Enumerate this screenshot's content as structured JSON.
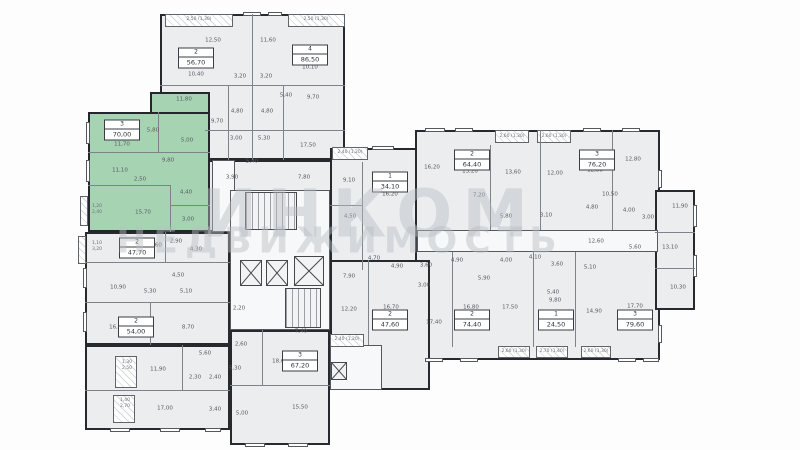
{
  "watermark": {
    "line1": "ИНКОМ",
    "line2": "НЕДВИЖИМОСТЬ"
  },
  "selected_apartment": {
    "number": "3",
    "area": "70,00",
    "highlight_color": "#a6d4b2"
  },
  "palette": {
    "wall": "#26292d",
    "room_fill": "#ebedef",
    "hall_fill": "#f7f8f9",
    "selected_fill": "#a6d4b2",
    "label_color": "#555a60",
    "watermark_color": "#b9bec3"
  },
  "blocks": [
    {
      "name": "block-top-left",
      "x": 160,
      "y": 14,
      "w": 185,
      "h": 146,
      "fill": "room"
    },
    {
      "name": "block-top-mid",
      "x": 205,
      "y": 160,
      "w": 140,
      "h": 72,
      "fill": "room"
    },
    {
      "name": "corridor-strip-left",
      "x": 212,
      "y": 160,
      "w": 23,
      "h": 72,
      "fill": "hall"
    },
    {
      "name": "block-left-column",
      "x": 85,
      "y": 232,
      "w": 145,
      "h": 113,
      "fill": "room"
    },
    {
      "name": "block-bottom-left",
      "x": 85,
      "y": 345,
      "w": 145,
      "h": 85,
      "fill": "room"
    },
    {
      "name": "block-core",
      "x": 230,
      "y": 190,
      "w": 100,
      "h": 140,
      "fill": "hall"
    },
    {
      "name": "block-apartment-1-34",
      "x": 330,
      "y": 148,
      "w": 88,
      "h": 122,
      "fill": "room"
    },
    {
      "name": "block-right-wing",
      "x": 415,
      "y": 130,
      "w": 245,
      "h": 230,
      "fill": "room"
    },
    {
      "name": "block-far-right",
      "x": 655,
      "y": 190,
      "w": 40,
      "h": 120,
      "fill": "room"
    },
    {
      "name": "block-bottom-center",
      "x": 230,
      "y": 330,
      "w": 100,
      "h": 115,
      "fill": "room"
    },
    {
      "name": "block-connector",
      "x": 330,
      "y": 260,
      "w": 100,
      "h": 130,
      "fill": "room"
    },
    {
      "name": "corridor-right-wing",
      "x": 417,
      "y": 230,
      "w": 241,
      "h": 22,
      "fill": "hall"
    },
    {
      "name": "corridor-connector-lobby",
      "x": 330,
      "y": 345,
      "w": 52,
      "h": 45,
      "fill": "hall"
    },
    {
      "name": "apartment-3-selected",
      "x": 88,
      "y": 112,
      "w": 122,
      "h": 120,
      "fill": "green"
    },
    {
      "name": "apartment-3-selected-upper",
      "x": 150,
      "y": 92,
      "w": 60,
      "h": 22,
      "fill": "green"
    }
  ],
  "partitions": [
    {
      "x": 252,
      "y": 14,
      "w": 1,
      "h": 146
    },
    {
      "x": 160,
      "y": 85,
      "w": 92,
      "h": 1
    },
    {
      "x": 252,
      "y": 85,
      "w": 93,
      "h": 1
    },
    {
      "x": 228,
      "y": 85,
      "w": 1,
      "h": 75
    },
    {
      "x": 283,
      "y": 85,
      "w": 1,
      "h": 75
    },
    {
      "x": 205,
      "y": 130,
      "w": 140,
      "h": 1
    },
    {
      "x": 88,
      "y": 152,
      "w": 122,
      "h": 1
    },
    {
      "x": 158,
      "y": 112,
      "w": 1,
      "h": 40
    },
    {
      "x": 88,
      "y": 185,
      "w": 82,
      "h": 1
    },
    {
      "x": 170,
      "y": 185,
      "w": 1,
      "h": 47
    },
    {
      "x": 170,
      "y": 205,
      "w": 40,
      "h": 1
    },
    {
      "x": 85,
      "y": 262,
      "w": 145,
      "h": 1
    },
    {
      "x": 85,
      "y": 302,
      "w": 145,
      "h": 1
    },
    {
      "x": 150,
      "y": 302,
      "w": 1,
      "h": 43
    },
    {
      "x": 165,
      "y": 232,
      "w": 1,
      "h": 30
    },
    {
      "x": 85,
      "y": 390,
      "w": 145,
      "h": 1
    },
    {
      "x": 182,
      "y": 345,
      "w": 1,
      "h": 45
    },
    {
      "x": 230,
      "y": 385,
      "w": 100,
      "h": 1
    },
    {
      "x": 262,
      "y": 330,
      "w": 1,
      "h": 55
    },
    {
      "x": 362,
      "y": 162,
      "w": 1,
      "h": 108
    },
    {
      "x": 330,
      "y": 205,
      "w": 32,
      "h": 1
    },
    {
      "x": 540,
      "y": 130,
      "w": 1,
      "h": 100
    },
    {
      "x": 490,
      "y": 145,
      "w": 1,
      "h": 85
    },
    {
      "x": 612,
      "y": 130,
      "w": 1,
      "h": 100
    },
    {
      "x": 452,
      "y": 252,
      "w": 1,
      "h": 95
    },
    {
      "x": 533,
      "y": 252,
      "w": 1,
      "h": 95
    },
    {
      "x": 575,
      "y": 252,
      "w": 1,
      "h": 95
    },
    {
      "x": 368,
      "y": 260,
      "w": 1,
      "h": 85
    },
    {
      "x": 655,
      "y": 232,
      "w": 40,
      "h": 1
    },
    {
      "x": 655,
      "y": 268,
      "w": 40,
      "h": 1
    }
  ],
  "windows": [
    {
      "x": 243,
      "y": 12,
      "w": 18,
      "h": 4
    },
    {
      "x": 268,
      "y": 12,
      "w": 14,
      "h": 4
    },
    {
      "x": 86,
      "y": 122,
      "w": 4,
      "h": 22
    },
    {
      "x": 86,
      "y": 160,
      "w": 4,
      "h": 22
    },
    {
      "x": 83,
      "y": 268,
      "w": 4,
      "h": 20
    },
    {
      "x": 83,
      "y": 312,
      "w": 4,
      "h": 20
    },
    {
      "x": 110,
      "y": 428,
      "w": 20,
      "h": 4
    },
    {
      "x": 160,
      "y": 428,
      "w": 20,
      "h": 4
    },
    {
      "x": 205,
      "y": 428,
      "w": 16,
      "h": 4
    },
    {
      "x": 245,
      "y": 443,
      "w": 20,
      "h": 4
    },
    {
      "x": 288,
      "y": 443,
      "w": 20,
      "h": 4
    },
    {
      "x": 372,
      "y": 146,
      "w": 22,
      "h": 4
    },
    {
      "x": 425,
      "y": 128,
      "w": 20,
      "h": 4
    },
    {
      "x": 455,
      "y": 128,
      "w": 18,
      "h": 4
    },
    {
      "x": 583,
      "y": 128,
      "w": 18,
      "h": 4
    },
    {
      "x": 622,
      "y": 128,
      "w": 18,
      "h": 4
    },
    {
      "x": 693,
      "y": 205,
      "w": 4,
      "h": 22
    },
    {
      "x": 693,
      "y": 255,
      "w": 4,
      "h": 22
    },
    {
      "x": 425,
      "y": 358,
      "w": 18,
      "h": 4
    },
    {
      "x": 460,
      "y": 358,
      "w": 18,
      "h": 4
    },
    {
      "x": 618,
      "y": 358,
      "w": 18,
      "h": 4
    },
    {
      "x": 643,
      "y": 358,
      "w": 16,
      "h": 4
    },
    {
      "x": 658,
      "y": 170,
      "w": 4,
      "h": 18
    },
    {
      "x": 658,
      "y": 325,
      "w": 4,
      "h": 18
    }
  ],
  "balconies": [
    {
      "x": 165,
      "y": 14,
      "w": 68,
      "h": 13
    },
    {
      "x": 288,
      "y": 14,
      "w": 57,
      "h": 13
    },
    {
      "x": 80,
      "y": 196,
      "w": 8,
      "h": 30
    },
    {
      "x": 78,
      "y": 236,
      "w": 8,
      "h": 28
    },
    {
      "x": 115,
      "y": 356,
      "w": 22,
      "h": 32
    },
    {
      "x": 113,
      "y": 395,
      "w": 22,
      "h": 28
    },
    {
      "x": 332,
      "y": 147,
      "w": 36,
      "h": 13
    },
    {
      "x": 495,
      "y": 130,
      "w": 34,
      "h": 13
    },
    {
      "x": 537,
      "y": 130,
      "w": 34,
      "h": 13
    },
    {
      "x": 330,
      "y": 334,
      "w": 34,
      "h": 13
    },
    {
      "x": 498,
      "y": 346,
      "w": 32,
      "h": 12
    },
    {
      "x": 536,
      "y": 346,
      "w": 32,
      "h": 12
    },
    {
      "x": 581,
      "y": 346,
      "w": 30,
      "h": 12
    }
  ],
  "stairs": [
    {
      "x": 245,
      "y": 192,
      "w": 52,
      "h": 38
    },
    {
      "x": 285,
      "y": 288,
      "w": 36,
      "h": 40
    }
  ],
  "elevators": [
    {
      "x": 240,
      "y": 260,
      "w": 22,
      "h": 26
    },
    {
      "x": 266,
      "y": 260,
      "w": 22,
      "h": 26
    },
    {
      "x": 294,
      "y": 256,
      "w": 30,
      "h": 30
    },
    {
      "x": 331,
      "y": 362,
      "w": 16,
      "h": 18
    }
  ],
  "apartment_labels": [
    {
      "number": "2",
      "area": "56,70",
      "x": 196,
      "y": 58
    },
    {
      "number": "4",
      "area": "86,50",
      "x": 310,
      "y": 55
    },
    {
      "number": "3",
      "area": "70,00",
      "x": 122,
      "y": 130
    },
    {
      "number": "2",
      "area": "47,70",
      "x": 137,
      "y": 248
    },
    {
      "number": "2",
      "area": "54,00",
      "x": 136,
      "y": 327
    },
    {
      "number": "1",
      "area": "34,10",
      "x": 390,
      "y": 182
    },
    {
      "number": "2",
      "area": "64,40",
      "x": 472,
      "y": 160
    },
    {
      "number": "3",
      "area": "76,20",
      "x": 597,
      "y": 160
    },
    {
      "number": "3",
      "area": "67,20",
      "x": 300,
      "y": 361
    },
    {
      "number": "2",
      "area": "47,60",
      "x": 390,
      "y": 320
    },
    {
      "number": "2",
      "area": "74,40",
      "x": 472,
      "y": 320
    },
    {
      "number": "1",
      "area": "24,50",
      "x": 556,
      "y": 320
    },
    {
      "number": "3",
      "area": "79,60",
      "x": 635,
      "y": 320
    }
  ],
  "room_labels": [
    {
      "text": "10,40",
      "x": 196,
      "y": 75
    },
    {
      "text": "12,50",
      "x": 213,
      "y": 41
    },
    {
      "text": "11,80",
      "x": 184,
      "y": 100
    },
    {
      "text": "3,20",
      "x": 240,
      "y": 77
    },
    {
      "text": "3,20",
      "x": 266,
      "y": 77
    },
    {
      "text": "11,60",
      "x": 268,
      "y": 41
    },
    {
      "text": "10,10",
      "x": 310,
      "y": 68
    },
    {
      "text": "5,40",
      "x": 286,
      "y": 96
    },
    {
      "text": "9,70",
      "x": 313,
      "y": 98
    },
    {
      "text": "4,80",
      "x": 237,
      "y": 112
    },
    {
      "text": "4,80",
      "x": 267,
      "y": 112
    },
    {
      "text": "9,70",
      "x": 217,
      "y": 122
    },
    {
      "text": "3,00",
      "x": 236,
      "y": 139
    },
    {
      "text": "5,30",
      "x": 264,
      "y": 139
    },
    {
      "text": "17,50",
      "x": 308,
      "y": 146
    },
    {
      "text": "5,40",
      "x": 252,
      "y": 162
    },
    {
      "text": "3,90",
      "x": 232,
      "y": 178
    },
    {
      "text": "7,80",
      "x": 304,
      "y": 178
    },
    {
      "text": "11,70",
      "x": 122,
      "y": 145
    },
    {
      "text": "5,80",
      "x": 153,
      "y": 131
    },
    {
      "text": "5,00",
      "x": 187,
      "y": 141
    },
    {
      "text": "9,80",
      "x": 168,
      "y": 161
    },
    {
      "text": "11,10",
      "x": 120,
      "y": 171
    },
    {
      "text": "2,50",
      "x": 140,
      "y": 180
    },
    {
      "text": "4,40",
      "x": 186,
      "y": 193
    },
    {
      "text": "15,70",
      "x": 143,
      "y": 213
    },
    {
      "text": "3,00",
      "x": 188,
      "y": 220
    },
    {
      "text": "13,60",
      "x": 154,
      "y": 246
    },
    {
      "text": "2,90",
      "x": 176,
      "y": 242
    },
    {
      "text": "4,30",
      "x": 196,
      "y": 250
    },
    {
      "text": "4,50",
      "x": 178,
      "y": 276
    },
    {
      "text": "10,90",
      "x": 118,
      "y": 288
    },
    {
      "text": "5,30",
      "x": 150,
      "y": 292
    },
    {
      "text": "5,10",
      "x": 186,
      "y": 292
    },
    {
      "text": "16,50",
      "x": 117,
      "y": 328
    },
    {
      "text": "8,70",
      "x": 188,
      "y": 328
    },
    {
      "text": "5,60",
      "x": 205,
      "y": 354
    },
    {
      "text": "2,60",
      "x": 241,
      "y": 345
    },
    {
      "text": "11,90",
      "x": 158,
      "y": 370
    },
    {
      "text": "2,30",
      "x": 195,
      "y": 378
    },
    {
      "text": "2,40",
      "x": 215,
      "y": 378
    },
    {
      "text": "5,30",
      "x": 235,
      "y": 369
    },
    {
      "text": "17,00",
      "x": 165,
      "y": 409
    },
    {
      "text": "3,40",
      "x": 215,
      "y": 410
    },
    {
      "text": "5,00",
      "x": 242,
      "y": 414
    },
    {
      "text": "7,40",
      "x": 301,
      "y": 332
    },
    {
      "text": "18,60",
      "x": 280,
      "y": 362
    },
    {
      "text": "15,50",
      "x": 300,
      "y": 408
    },
    {
      "text": "2,20",
      "x": 239,
      "y": 309
    },
    {
      "text": "9,10",
      "x": 349,
      "y": 181
    },
    {
      "text": "16,20",
      "x": 390,
      "y": 195
    },
    {
      "text": "4,50",
      "x": 350,
      "y": 217
    },
    {
      "text": "12,20",
      "x": 349,
      "y": 310
    },
    {
      "text": "16,70",
      "x": 391,
      "y": 308
    },
    {
      "text": "3,00",
      "x": 424,
      "y": 286
    },
    {
      "text": "4,70",
      "x": 374,
      "y": 259
    },
    {
      "text": "7,90",
      "x": 349,
      "y": 277
    },
    {
      "text": "4,90",
      "x": 397,
      "y": 267
    },
    {
      "text": "3,60",
      "x": 426,
      "y": 266
    },
    {
      "text": "16,20",
      "x": 432,
      "y": 168
    },
    {
      "text": "13,20",
      "x": 470,
      "y": 172
    },
    {
      "text": "13,60",
      "x": 513,
      "y": 173
    },
    {
      "text": "7,20",
      "x": 479,
      "y": 196
    },
    {
      "text": "5,80",
      "x": 506,
      "y": 217
    },
    {
      "text": "4,90",
      "x": 457,
      "y": 261
    },
    {
      "text": "4,00",
      "x": 506,
      "y": 261
    },
    {
      "text": "4,10",
      "x": 535,
      "y": 258
    },
    {
      "text": "3,60",
      "x": 557,
      "y": 265
    },
    {
      "text": "5,90",
      "x": 484,
      "y": 279
    },
    {
      "text": "12,00",
      "x": 555,
      "y": 174
    },
    {
      "text": "12,80",
      "x": 595,
      "y": 171
    },
    {
      "text": "12,80",
      "x": 633,
      "y": 160
    },
    {
      "text": "10,50",
      "x": 610,
      "y": 195
    },
    {
      "text": "4,80",
      "x": 592,
      "y": 208
    },
    {
      "text": "4,00",
      "x": 629,
      "y": 211
    },
    {
      "text": "3,00",
      "x": 648,
      "y": 218
    },
    {
      "text": "3,10",
      "x": 546,
      "y": 216
    },
    {
      "text": "11,90",
      "x": 680,
      "y": 207
    },
    {
      "text": "5,60",
      "x": 635,
      "y": 248
    },
    {
      "text": "13,10",
      "x": 670,
      "y": 248
    },
    {
      "text": "10,30",
      "x": 678,
      "y": 288
    },
    {
      "text": "12,60",
      "x": 596,
      "y": 242
    },
    {
      "text": "5,10",
      "x": 590,
      "y": 268
    },
    {
      "text": "17,40",
      "x": 434,
      "y": 323
    },
    {
      "text": "16,80",
      "x": 471,
      "y": 308
    },
    {
      "text": "17,50",
      "x": 510,
      "y": 308
    },
    {
      "text": "5,40",
      "x": 553,
      "y": 293
    },
    {
      "text": "9,80",
      "x": 555,
      "y": 301
    },
    {
      "text": "14,90",
      "x": 594,
      "y": 312
    },
    {
      "text": "17,70",
      "x": 635,
      "y": 307
    }
  ],
  "balcony_labels": [
    {
      "text": "2,50 (1,30)",
      "x": 199,
      "y": 20
    },
    {
      "text": "2,50 (1,30)",
      "x": 316,
      "y": 20
    },
    {
      "text": "2,40 (1,20)",
      "x": 350,
      "y": 153
    },
    {
      "text": "2,60 (1,30)",
      "x": 512,
      "y": 137
    },
    {
      "text": "2,60 (1,30)",
      "x": 554,
      "y": 137
    },
    {
      "text": "2,40 (1,20)",
      "x": 347,
      "y": 340
    },
    {
      "text": "2,60 (1,30)",
      "x": 514,
      "y": 352
    },
    {
      "text": "2,70 (1,40)",
      "x": 552,
      "y": 352
    },
    {
      "text": "2,60 (1,30)",
      "x": 596,
      "y": 352
    },
    {
      "text": "1,20\n2,40",
      "x": 97,
      "y": 210
    },
    {
      "text": "1,10\n3,20",
      "x": 97,
      "y": 247
    },
    {
      "text": "1,30\n2,50",
      "x": 127,
      "y": 366
    },
    {
      "text": "1,40\n2,70",
      "x": 125,
      "y": 404
    }
  ]
}
